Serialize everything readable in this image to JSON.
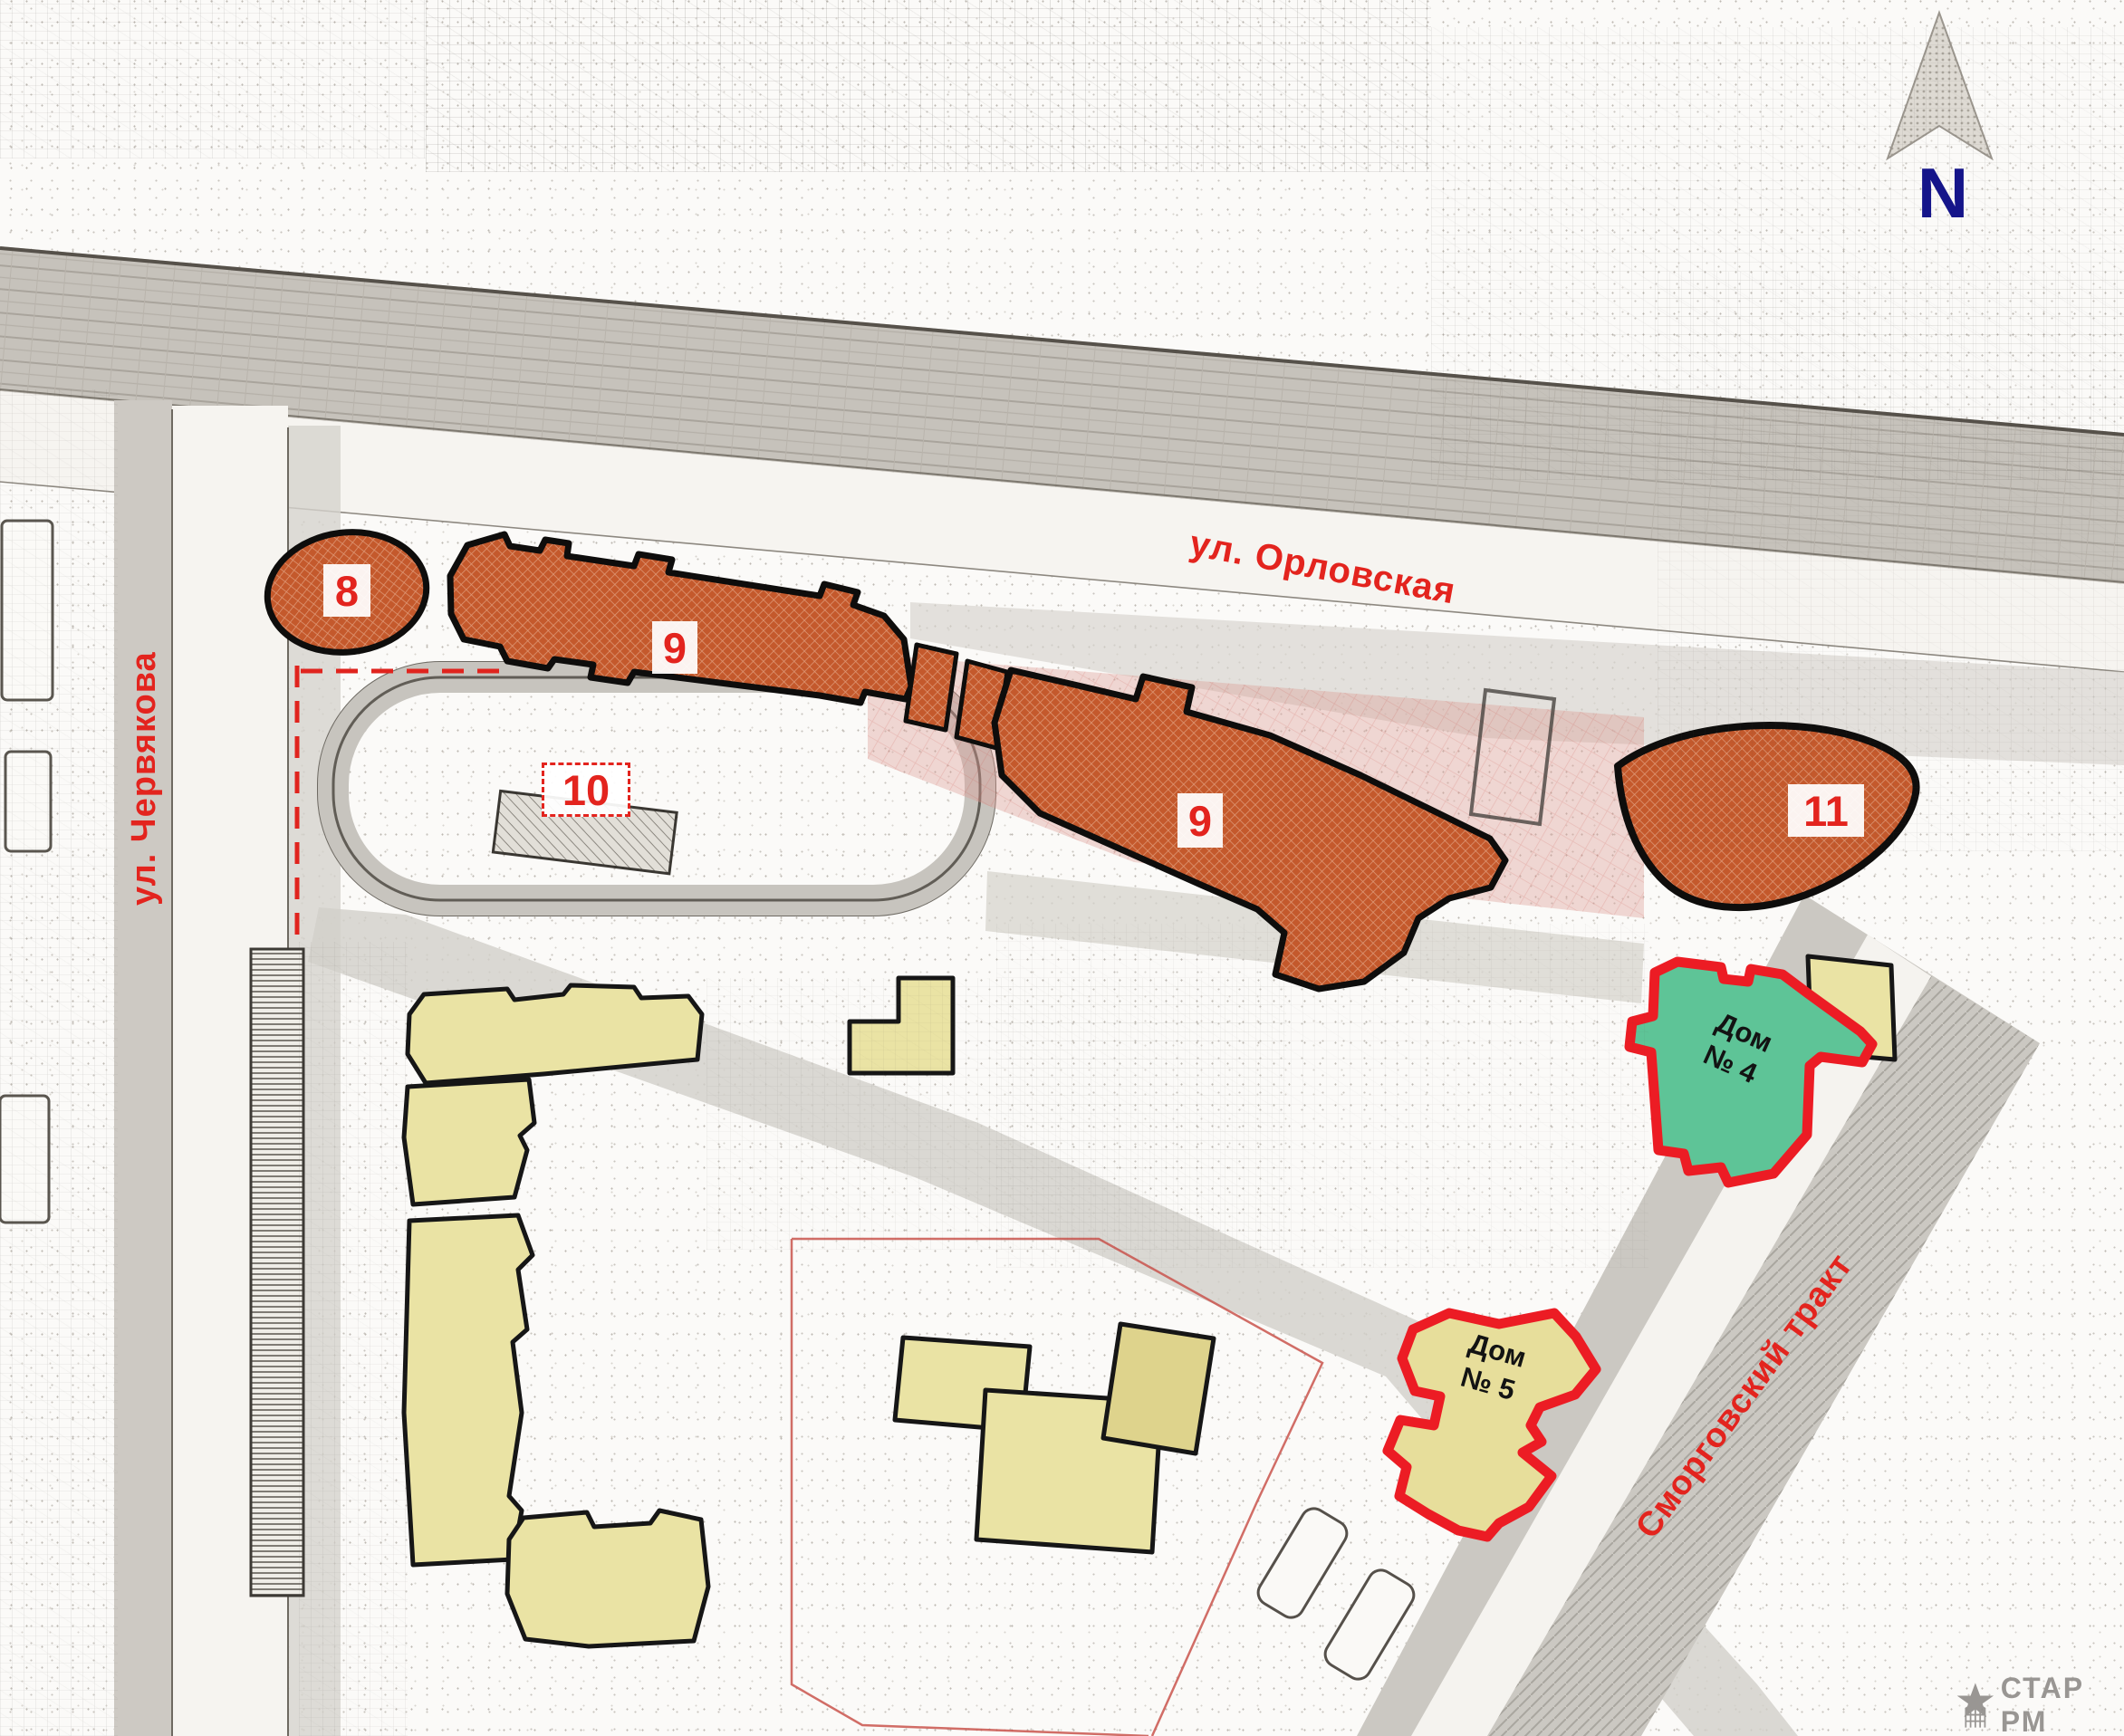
{
  "compass": {
    "north_letter": "N"
  },
  "streets": {
    "orlovskaya": "ул. Орловская",
    "chervyakova": "ул. Червякова",
    "smorgovsky_trakt": "Сморговский тракт"
  },
  "plots": [
    {
      "number": "8"
    },
    {
      "number": "9"
    },
    {
      "number": "10"
    },
    {
      "number": "9"
    },
    {
      "number": "11"
    }
  ],
  "houses": {
    "house4": {
      "line1": "Дом",
      "line2": "№ 4"
    },
    "house5": {
      "line1": "Дом",
      "line2": "№ 5"
    }
  },
  "watermark": "СТАР РМ",
  "colors": {
    "label_red": "#e3241e",
    "planned_building_fill": "#c4592c",
    "house4_fill": "#5ec497",
    "house_outline_red": "#ec1c24",
    "house5_fill": "#e7de9b",
    "existing_building_fill": "#eae3a4",
    "north_letter_blue": "#15158a",
    "watermark_gray": "#8f8c89"
  }
}
